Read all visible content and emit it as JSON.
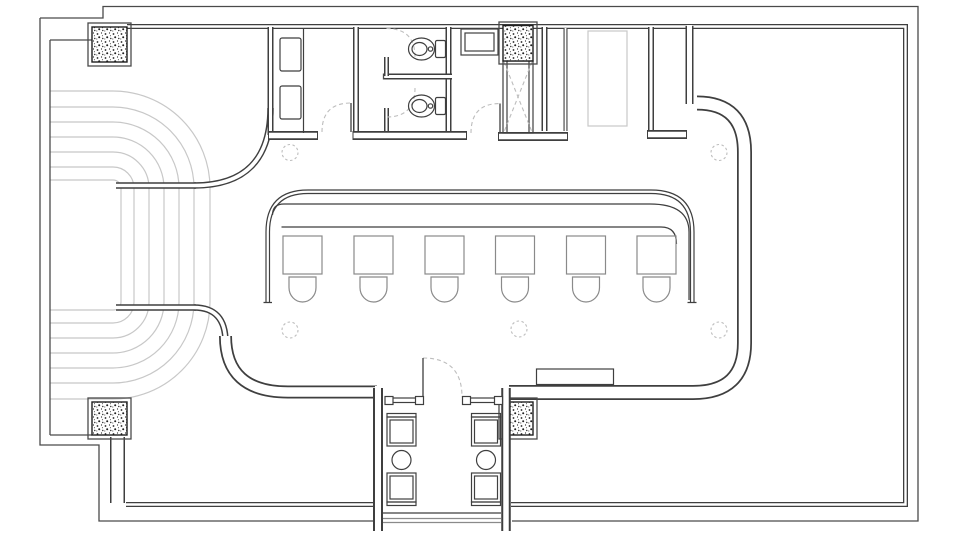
{
  "drawing": {
    "kind": "floor-plan",
    "visible_text": [],
    "colors": {
      "background": "#ffffff",
      "paper": "#ffffff",
      "wall": "#3f3f3f",
      "boundary": "#4a4a4a",
      "furniture": "#8a8a8a",
      "light_lines": "#c8c8c8",
      "dashed_symbols": "#bdbdbd",
      "hatch_dots": "#1f1f1f"
    },
    "inventory": {
      "structural_columns": 4,
      "bar_tables": 6,
      "bar_stools": 6,
      "toilets": 2,
      "sinks": 2,
      "toilet_stalls": 2,
      "entry_round_tables": 2,
      "entry_chairs": 4,
      "terrace_contour_rows": 7,
      "dashed_ceiling_markers": 5,
      "door_swings": 5,
      "service_shaft": 1,
      "bench": 1
    }
  }
}
